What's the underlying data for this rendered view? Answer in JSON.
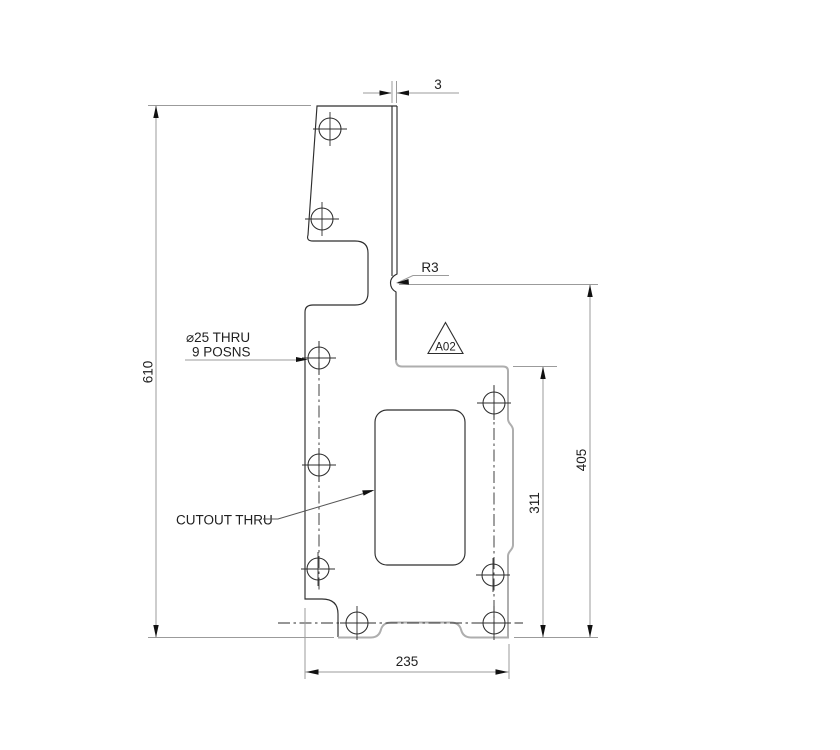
{
  "drawing": {
    "kind": "2D engineering part drawing, side profile with holes and cutout",
    "annotations": {
      "wall_thickness": "3",
      "corner_radius": "R3",
      "flag_label": "A02",
      "hole_note_line1": "⌀25 THRU",
      "hole_note_line2": "9 POSNS",
      "cutout_note": "CUTOUT THRU"
    },
    "dimensions": {
      "overall_height": "610",
      "right_height": "405",
      "inner_height": "311",
      "bottom_width": "235"
    }
  },
  "colors": {
    "background": "#ffffff",
    "outline": "#2d2d2d",
    "outline_light": "#aeaeae",
    "dimension": "#9b9b9b",
    "leader": "#555555",
    "text": "#1f1f1f",
    "arrow": "#111111"
  }
}
